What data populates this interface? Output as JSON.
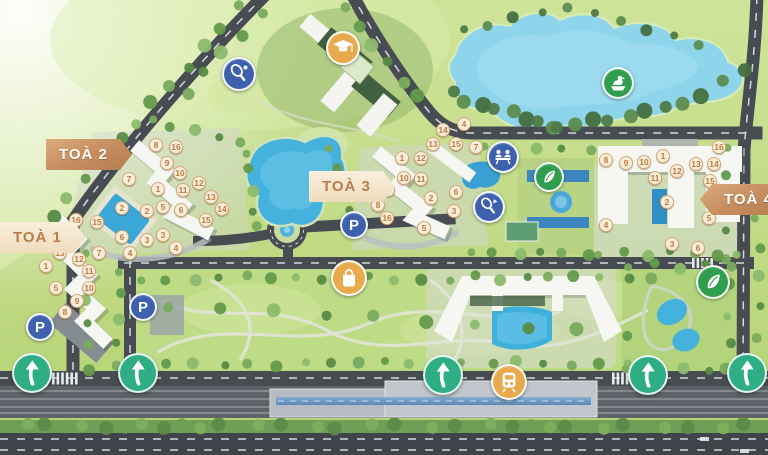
{
  "page": {
    "type": "residential-masterplan-map"
  },
  "colors": {
    "copper": "#c28a5e",
    "cream": "#f6ead4",
    "marker_border": "#d8a977",
    "marker_text": "#bf7a3e",
    "blue": "#3e61ae",
    "green": "#2f9e4f",
    "orange": "#e9a94d",
    "teal": "#2fae85",
    "lake": "#8ed5ec",
    "pool": "#3aa7d8",
    "road": "#474c52",
    "grass": "#c3db82"
  },
  "tower_labels": [
    {
      "id": "toa-1",
      "text": "TOÀ 1",
      "style": "light",
      "arrow": "right",
      "x": 0,
      "y": 222
    },
    {
      "id": "toa-2",
      "text": "TOÀ 2",
      "style": "solid",
      "arrow": "right",
      "x": 46,
      "y": 139
    },
    {
      "id": "toa-3",
      "text": "TOÀ 3",
      "style": "light",
      "arrow": "right",
      "x": 309,
      "y": 171
    },
    {
      "id": "toa-4",
      "text": "TOÀ 4",
      "style": "solid",
      "arrow": "left",
      "x": 700,
      "y": 184
    }
  ],
  "unit_markers": [
    {
      "tower": 1,
      "n": 1,
      "x": 46,
      "y": 266
    },
    {
      "tower": 1,
      "n": 2,
      "x": 122,
      "y": 208
    },
    {
      "tower": 1,
      "n": 3,
      "x": 147,
      "y": 240
    },
    {
      "tower": 1,
      "n": 4,
      "x": 130,
      "y": 253
    },
    {
      "tower": 1,
      "n": 5,
      "x": 56,
      "y": 288
    },
    {
      "tower": 1,
      "n": 6,
      "x": 122,
      "y": 237
    },
    {
      "tower": 1,
      "n": 7,
      "x": 99,
      "y": 253
    },
    {
      "tower": 1,
      "n": 8,
      "x": 65,
      "y": 312
    },
    {
      "tower": 1,
      "n": 9,
      "x": 77,
      "y": 301
    },
    {
      "tower": 1,
      "n": 10,
      "x": 89,
      "y": 288
    },
    {
      "tower": 1,
      "n": 11,
      "x": 89,
      "y": 271
    },
    {
      "tower": 1,
      "n": 12,
      "x": 79,
      "y": 259
    },
    {
      "tower": 1,
      "n": 13,
      "x": 60,
      "y": 253
    },
    {
      "tower": 1,
      "n": 14,
      "x": 73,
      "y": 239
    },
    {
      "tower": 1,
      "n": 15,
      "x": 97,
      "y": 222
    },
    {
      "tower": 1,
      "n": 16,
      "x": 76,
      "y": 220
    },
    {
      "tower": 2,
      "n": 1,
      "x": 158,
      "y": 189
    },
    {
      "tower": 2,
      "n": 2,
      "x": 147,
      "y": 211
    },
    {
      "tower": 2,
      "n": 3,
      "x": 163,
      "y": 235
    },
    {
      "tower": 2,
      "n": 4,
      "x": 176,
      "y": 248
    },
    {
      "tower": 2,
      "n": 5,
      "x": 163,
      "y": 207
    },
    {
      "tower": 2,
      "n": 6,
      "x": 181,
      "y": 210
    },
    {
      "tower": 2,
      "n": 7,
      "x": 129,
      "y": 179
    },
    {
      "tower": 2,
      "n": 8,
      "x": 156,
      "y": 145
    },
    {
      "tower": 2,
      "n": 9,
      "x": 167,
      "y": 163
    },
    {
      "tower": 2,
      "n": 10,
      "x": 180,
      "y": 173
    },
    {
      "tower": 2,
      "n": 11,
      "x": 183,
      "y": 190
    },
    {
      "tower": 2,
      "n": 12,
      "x": 199,
      "y": 183
    },
    {
      "tower": 2,
      "n": 13,
      "x": 211,
      "y": 197
    },
    {
      "tower": 2,
      "n": 14,
      "x": 222,
      "y": 209
    },
    {
      "tower": 2,
      "n": 15,
      "x": 206,
      "y": 220
    },
    {
      "tower": 2,
      "n": 16,
      "x": 176,
      "y": 147
    },
    {
      "tower": 3,
      "n": 1,
      "x": 402,
      "y": 158
    },
    {
      "tower": 3,
      "n": 2,
      "x": 431,
      "y": 198
    },
    {
      "tower": 3,
      "n": 3,
      "x": 454,
      "y": 211
    },
    {
      "tower": 3,
      "n": 4,
      "x": 464,
      "y": 124
    },
    {
      "tower": 3,
      "n": 5,
      "x": 424,
      "y": 228
    },
    {
      "tower": 3,
      "n": 6,
      "x": 456,
      "y": 192
    },
    {
      "tower": 3,
      "n": 7,
      "x": 476,
      "y": 147
    },
    {
      "tower": 3,
      "n": 8,
      "x": 378,
      "y": 205
    },
    {
      "tower": 3,
      "n": 9,
      "x": 388,
      "y": 190
    },
    {
      "tower": 3,
      "n": 10,
      "x": 404,
      "y": 178
    },
    {
      "tower": 3,
      "n": 11,
      "x": 421,
      "y": 179
    },
    {
      "tower": 3,
      "n": 12,
      "x": 421,
      "y": 158
    },
    {
      "tower": 3,
      "n": 13,
      "x": 433,
      "y": 144
    },
    {
      "tower": 3,
      "n": 14,
      "x": 443,
      "y": 130
    },
    {
      "tower": 3,
      "n": 15,
      "x": 456,
      "y": 144
    },
    {
      "tower": 3,
      "n": 16,
      "x": 387,
      "y": 218
    },
    {
      "tower": 4,
      "n": 1,
      "x": 663,
      "y": 156
    },
    {
      "tower": 4,
      "n": 2,
      "x": 667,
      "y": 202
    },
    {
      "tower": 4,
      "n": 3,
      "x": 672,
      "y": 244
    },
    {
      "tower": 4,
      "n": 4,
      "x": 606,
      "y": 225
    },
    {
      "tower": 4,
      "n": 5,
      "x": 709,
      "y": 218
    },
    {
      "tower": 4,
      "n": 6,
      "x": 698,
      "y": 248
    },
    {
      "tower": 4,
      "n": 8,
      "x": 606,
      "y": 160
    },
    {
      "tower": 4,
      "n": 9,
      "x": 626,
      "y": 163
    },
    {
      "tower": 4,
      "n": 10,
      "x": 644,
      "y": 162
    },
    {
      "tower": 4,
      "n": 11,
      "x": 655,
      "y": 178
    },
    {
      "tower": 4,
      "n": 12,
      "x": 677,
      "y": 171
    },
    {
      "tower": 4,
      "n": 13,
      "x": 696,
      "y": 164
    },
    {
      "tower": 4,
      "n": 14,
      "x": 714,
      "y": 164
    },
    {
      "tower": 4,
      "n": 15,
      "x": 710,
      "y": 181
    },
    {
      "tower": 4,
      "n": 16,
      "x": 719,
      "y": 147
    }
  ],
  "amenity_icons": [
    {
      "name": "tennis-icon",
      "shape": "tennis",
      "color": "blue",
      "x": 239,
      "y": 74,
      "d": 34
    },
    {
      "name": "school-icon",
      "shape": "graduation",
      "color": "orange",
      "x": 343,
      "y": 48,
      "d": 34
    },
    {
      "name": "boating-icon",
      "shape": "duck",
      "color": "green",
      "x": 618,
      "y": 83,
      "d": 32
    },
    {
      "name": "playground-icon",
      "shape": "picnic",
      "color": "blue",
      "x": 503,
      "y": 157,
      "d": 32
    },
    {
      "name": "greenspace-icon",
      "shape": "leaf",
      "color": "green",
      "x": 549,
      "y": 177,
      "d": 30
    },
    {
      "name": "badminton-icon",
      "shape": "badminton",
      "color": "blue",
      "x": 489,
      "y": 207,
      "d": 32
    },
    {
      "name": "greenspace-icon",
      "shape": "leaf",
      "color": "green",
      "x": 713,
      "y": 282,
      "d": 34
    },
    {
      "name": "shopping-icon",
      "shape": "bag",
      "color": "orange",
      "x": 349,
      "y": 278,
      "d": 36
    },
    {
      "name": "metro-icon",
      "shape": "train",
      "color": "orange",
      "x": 509,
      "y": 382,
      "d": 36
    },
    {
      "name": "parking-icon",
      "shape": "p",
      "color": "blue",
      "x": 40,
      "y": 327,
      "d": 28
    },
    {
      "name": "parking-icon",
      "shape": "p",
      "color": "blue",
      "x": 143,
      "y": 307,
      "d": 28
    },
    {
      "name": "parking-icon",
      "shape": "p",
      "color": "blue",
      "x": 354,
      "y": 225,
      "d": 28
    }
  ],
  "direction_arrows": [
    {
      "x": 32,
      "y": 373
    },
    {
      "x": 138,
      "y": 373
    },
    {
      "x": 443,
      "y": 375
    },
    {
      "x": 648,
      "y": 375
    },
    {
      "x": 747,
      "y": 373
    }
  ]
}
